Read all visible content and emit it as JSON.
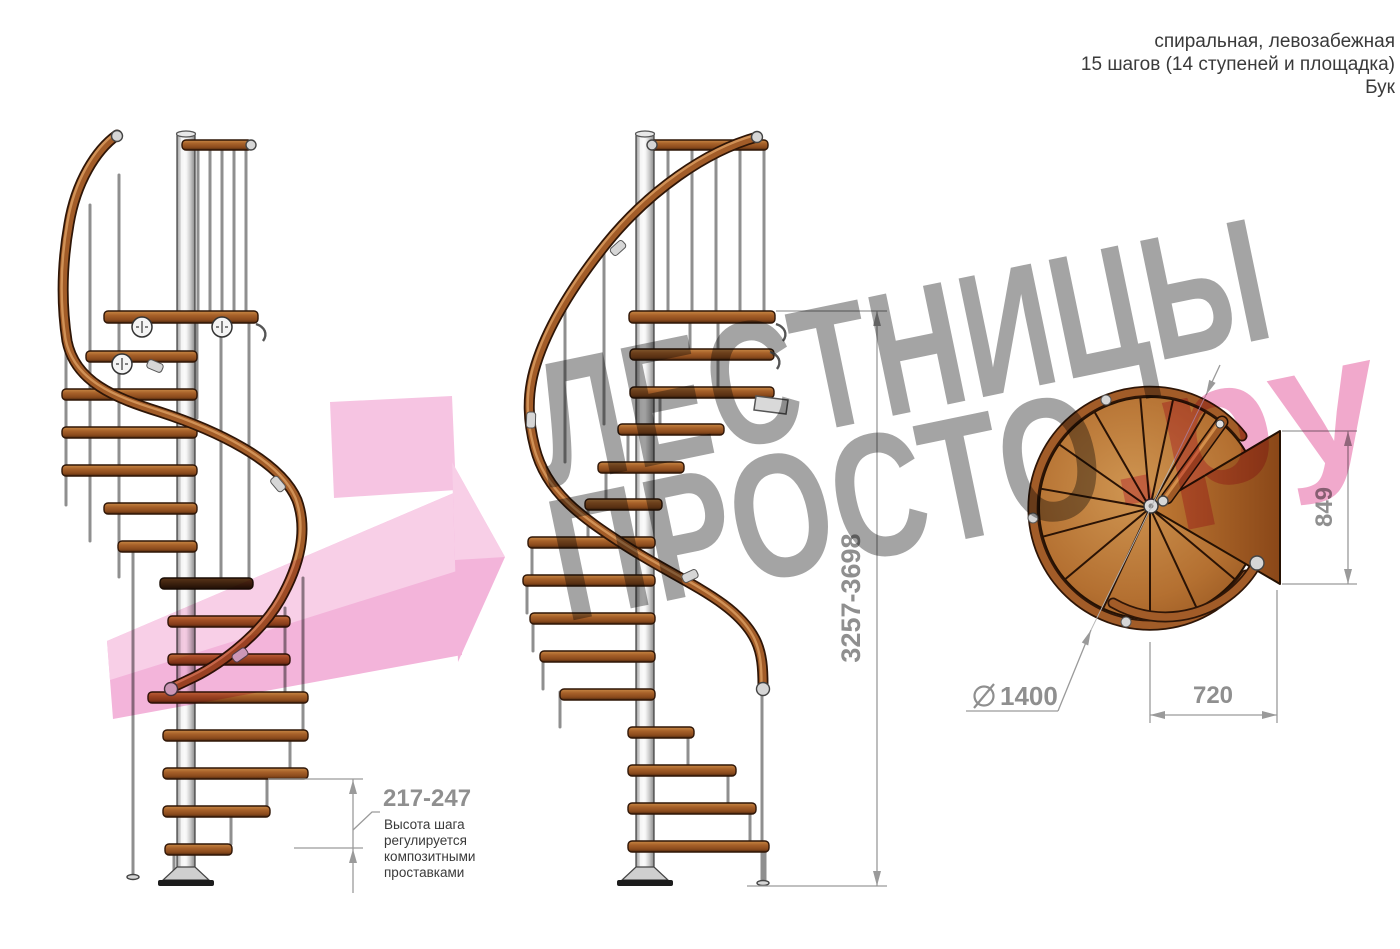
{
  "header": {
    "line1": "спиральная, левозабежная",
    "line2": "15 шагов (14 ступеней и площадка)",
    "line3": "Бук"
  },
  "watermark": {
    "word1": "ЛЕСТНИЦЫ",
    "word2": "ПРОСТО",
    "suffix": ".ру",
    "gray": "#9d9d9d",
    "pink": "#f0a3c8",
    "arrow_pink": "#f3aed8"
  },
  "dimensions": {
    "total_height": "3257-3698",
    "landing_depth": "849",
    "landing_width": "720",
    "diameter_symbol": "⌀",
    "diameter_value": "1400",
    "step_height": "217-247",
    "step_height_note_line1": "Высота шага",
    "step_height_note_line2": "регулируется",
    "step_height_note_line3": "композитными",
    "step_height_note_line4": "проставками"
  }
}
